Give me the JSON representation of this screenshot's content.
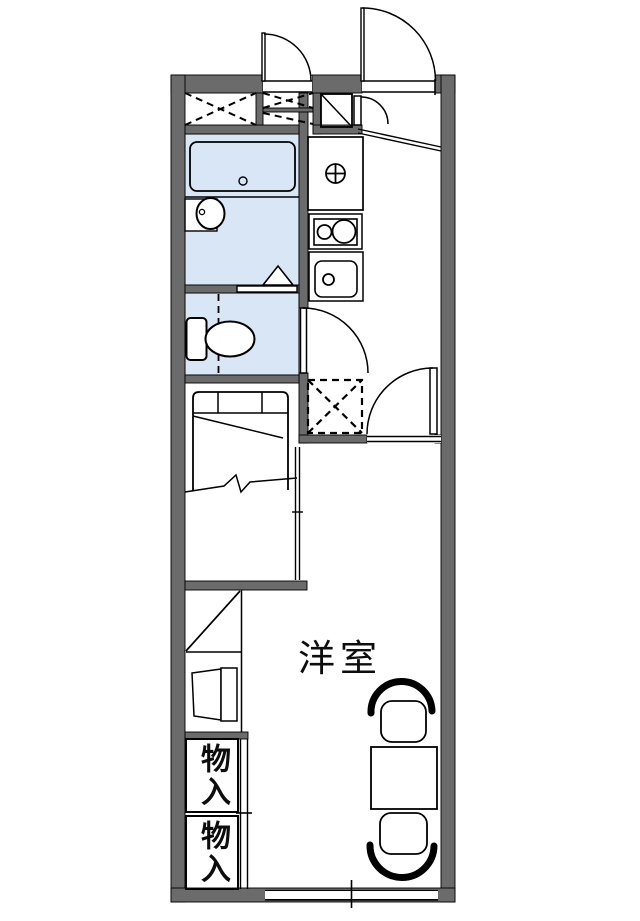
{
  "floor_plan": {
    "room_label": "洋室",
    "storage_boxes": [
      {
        "label": "物入"
      },
      {
        "label": "物入"
      }
    ],
    "colors": {
      "wall": "#6b6b6b",
      "blue": "#d8e6f6",
      "blue-light": "#e4eefb",
      "cream": "#faf0d8",
      "line": "#000000"
    }
  }
}
